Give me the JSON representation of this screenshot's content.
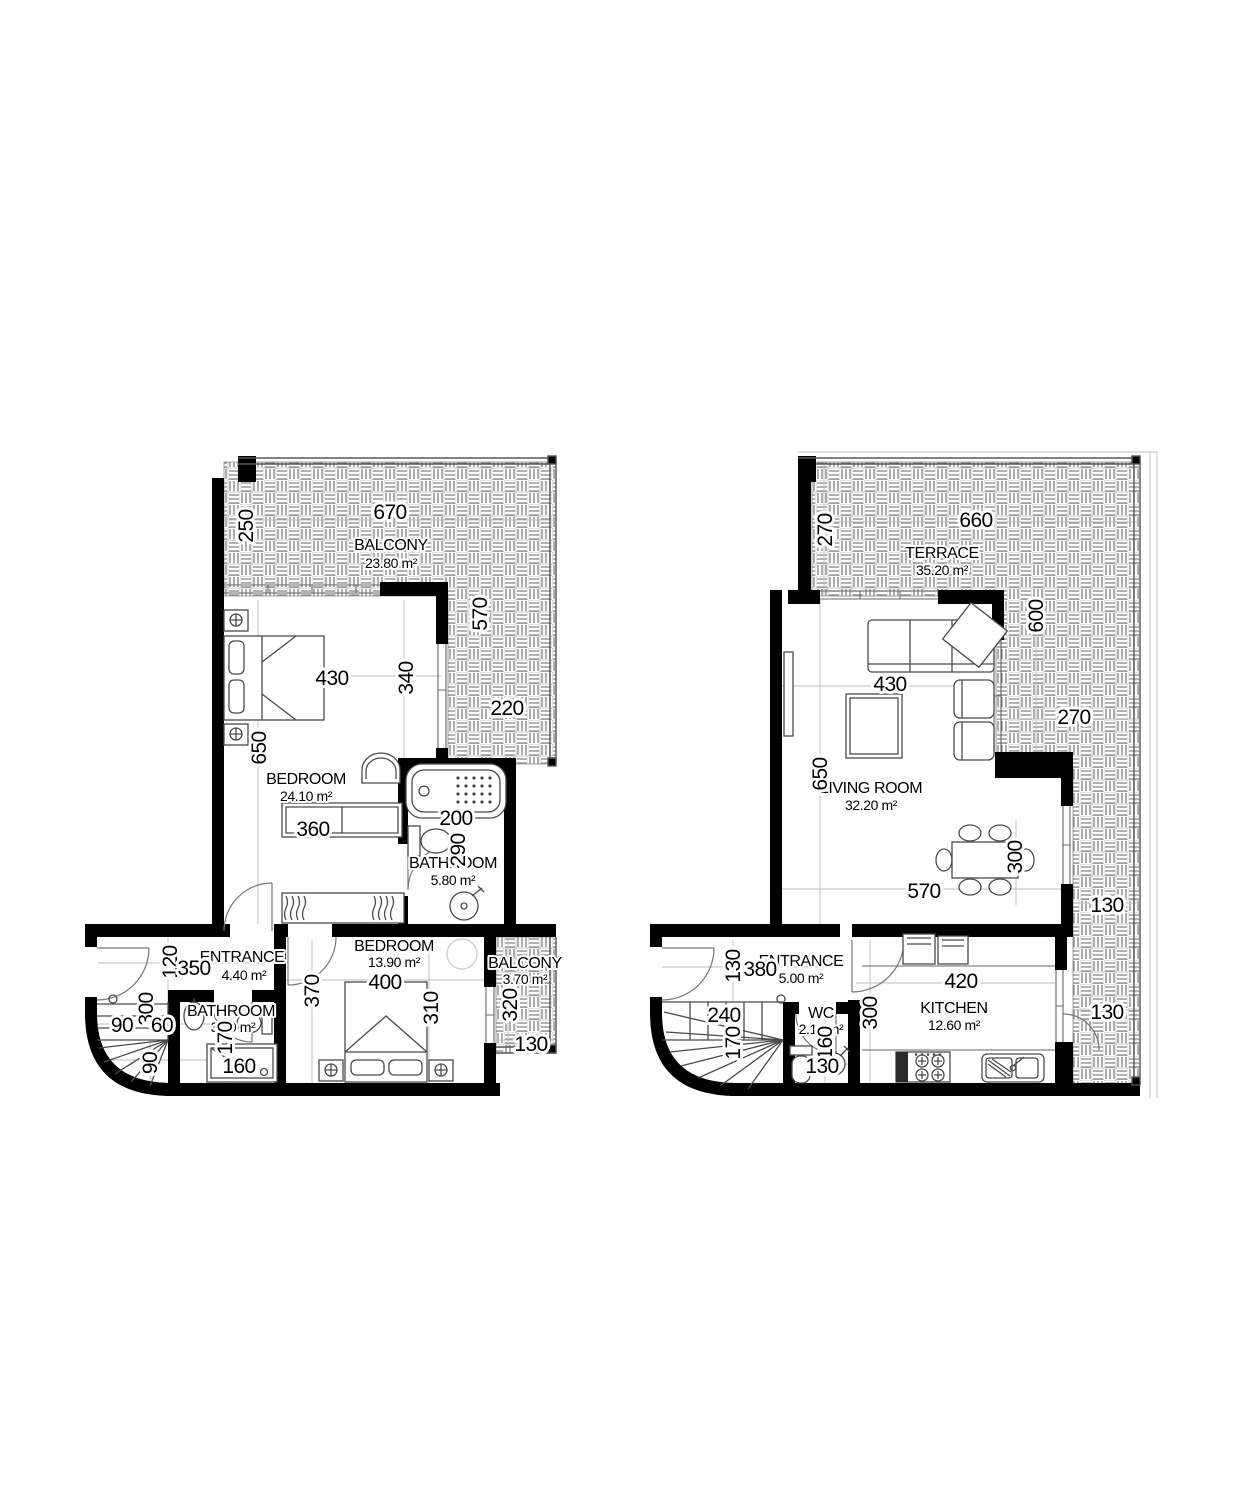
{
  "plans": {
    "left": {
      "rooms": [
        {
          "name": "BALCONY",
          "area": "23.80 m²"
        },
        {
          "name": "BEDROOM",
          "area": "24.10 m²"
        },
        {
          "name": "BATHROOM",
          "area": "5.80 m²"
        },
        {
          "name": "ENTRANCE",
          "area": "4.40 m²"
        },
        {
          "name": "BATHROOM",
          "area": "3.00 m²"
        },
        {
          "name": "BEDROOM",
          "area": "13.90 m²"
        },
        {
          "name": "BALCONY",
          "area": "3.70 m²"
        }
      ],
      "dims": [
        "670",
        "250",
        "570",
        "430",
        "340",
        "220",
        "650",
        "360",
        "200",
        "290",
        "120",
        "350",
        "300",
        "90",
        "60",
        "370",
        "90",
        "170",
        "160",
        "400",
        "310",
        "320",
        "130"
      ]
    },
    "right": {
      "rooms": [
        {
          "name": "TERRACE",
          "area": "35.20 m²"
        },
        {
          "name": "LIVING ROOM",
          "area": "32.20 m²"
        },
        {
          "name": "ENTRANCE",
          "area": "5.00 m²"
        },
        {
          "name": "WC",
          "area": "2.10 m²"
        },
        {
          "name": "KITCHEN",
          "area": "12.60 m²"
        }
      ],
      "dims": [
        "660",
        "270",
        "600",
        "430",
        "270",
        "650",
        "300",
        "570",
        "130",
        "130",
        "380",
        "240",
        "170",
        "160",
        "130",
        "300",
        "420",
        "130"
      ]
    }
  }
}
